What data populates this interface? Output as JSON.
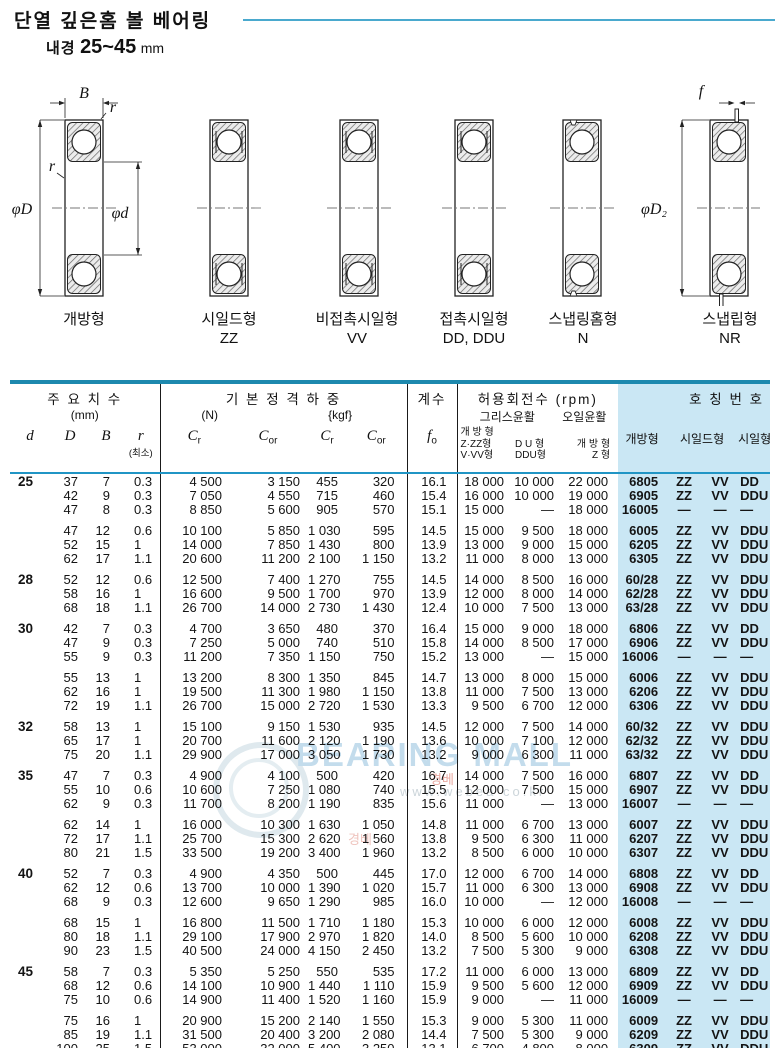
{
  "page": {
    "title": "단열 깊은홈 볼 베어링",
    "subtitle_label": "내경",
    "subtitle_range": "25~45",
    "subtitle_unit": "mm"
  },
  "diagrams": {
    "dim_labels": {
      "B": "B",
      "r": "r",
      "phi_D": "φD",
      "phi_d": "φd",
      "phi_D2": "φD₂",
      "f": "f"
    },
    "types": [
      {
        "name": "개방형",
        "code": ""
      },
      {
        "name": "시일드형",
        "code": "ZZ"
      },
      {
        "name": "비접촉시일형",
        "code": "VV"
      },
      {
        "name": "접촉시일형",
        "code": "DD, DDU"
      },
      {
        "name": "스냅링홈형",
        "code": "N"
      },
      {
        "name": "스냅립형",
        "code": "NR"
      }
    ]
  },
  "watermark": {
    "logo_text": "BEARING MALL",
    "url_text": "www.webea co.kr",
    "red_fragment": "경베"
  },
  "colors": {
    "title_rule": "#4aa9ce",
    "table_border_top": "#1d89ae",
    "table_border_bottom": "#3ab1d8",
    "header_divider": "#2095c5",
    "panel_blue": "#cae7f4"
  },
  "table": {
    "headers": {
      "dims_title": "주 요 치 수",
      "dims_unit": "(mm)",
      "d": "d",
      "D": "D",
      "B": "B",
      "r": "r",
      "r_min": "(최소)",
      "load_title": "기 본 정 격 하 중",
      "load_unit_n": "(N)",
      "load_unit_kgf": "{kgf}",
      "c": "C",
      "c_sub_r": "r",
      "c_sub_or": "or",
      "factor_title": "계수",
      "f0": "f",
      "f0_sub": "o",
      "speed_title": "허용회전수 (rpm)",
      "grease": "그리스윤활",
      "oil": "오일윤활",
      "speed_col1_l1": "개 방 형",
      "speed_col1_l2": "Z·ZZ형",
      "speed_col1_l3": "V·VV형",
      "speed_col2_l1": "D U 형",
      "speed_col2_l2": "DDU형",
      "speed_col3_l1": "개 방 형",
      "speed_col3_l2": "Z 형",
      "number_title": "호 칭 번 호",
      "num_open": "개방형",
      "num_shield": "시일드형",
      "num_seal": "시일형"
    },
    "groups": [
      {
        "d": "25",
        "subgroups": [
          [
            [
              "37",
              "7",
              "0.3",
              "4 500",
              "3 150",
              "455",
              "320",
              "16.1",
              "18 000",
              "10 000",
              "22 000",
              "6805",
              "ZZ",
              "VV",
              "DD"
            ],
            [
              "42",
              "9",
              "0.3",
              "7 050",
              "4 550",
              "715",
              "460",
              "15.4",
              "16 000",
              "10 000",
              "19 000",
              "6905",
              "ZZ",
              "VV",
              "DDU"
            ],
            [
              "47",
              "8",
              "0.3",
              "8 850",
              "5 600",
              "905",
              "570",
              "15.1",
              "15 000",
              "—",
              "18 000",
              "16005",
              "—",
              "—",
              "—"
            ]
          ],
          [
            [
              "47",
              "12",
              "0.6",
              "10 100",
              "5 850",
              "1 030",
              "595",
              "14.5",
              "15 000",
              "9 500",
              "18 000",
              "6005",
              "ZZ",
              "VV",
              "DDU"
            ],
            [
              "52",
              "15",
              "1",
              "14 000",
              "7 850",
              "1 430",
              "800",
              "13.9",
              "13 000",
              "9 000",
              "15 000",
              "6205",
              "ZZ",
              "VV",
              "DDU"
            ],
            [
              "62",
              "17",
              "1.1",
              "20 600",
              "11 200",
              "2 100",
              "1 150",
              "13.2",
              "11 000",
              "8 000",
              "13 000",
              "6305",
              "ZZ",
              "VV",
              "DDU"
            ]
          ]
        ]
      },
      {
        "d": "28",
        "subgroups": [
          [
            [
              "52",
              "12",
              "0.6",
              "12 500",
              "7 400",
              "1 270",
              "755",
              "14.5",
              "14 000",
              "8 500",
              "16 000",
              "60/28",
              "ZZ",
              "VV",
              "DDU"
            ],
            [
              "58",
              "16",
              "1",
              "16 600",
              "9 500",
              "1 700",
              "970",
              "13.9",
              "12 000",
              "8 000",
              "14 000",
              "62/28",
              "ZZ",
              "VV",
              "DDU"
            ],
            [
              "68",
              "18",
              "1.1",
              "26 700",
              "14 000",
              "2 730",
              "1 430",
              "12.4",
              "10 000",
              "7 500",
              "13 000",
              "63/28",
              "ZZ",
              "VV",
              "DDU"
            ]
          ]
        ]
      },
      {
        "d": "30",
        "subgroups": [
          [
            [
              "42",
              "7",
              "0.3",
              "4 700",
              "3 650",
              "480",
              "370",
              "16.4",
              "15 000",
              "9 000",
              "18 000",
              "6806",
              "ZZ",
              "VV",
              "DD"
            ],
            [
              "47",
              "9",
              "0.3",
              "7 250",
              "5 000",
              "740",
              "510",
              "15.8",
              "14 000",
              "8 500",
              "17 000",
              "6906",
              "ZZ",
              "VV",
              "DDU"
            ],
            [
              "55",
              "9",
              "0.3",
              "11 200",
              "7 350",
              "1 150",
              "750",
              "15.2",
              "13 000",
              "—",
              "15 000",
              "16006",
              "—",
              "—",
              "—"
            ]
          ],
          [
            [
              "55",
              "13",
              "1",
              "13 200",
              "8 300",
              "1 350",
              "845",
              "14.7",
              "13 000",
              "8 000",
              "15 000",
              "6006",
              "ZZ",
              "VV",
              "DDU"
            ],
            [
              "62",
              "16",
              "1",
              "19 500",
              "11 300",
              "1 980",
              "1 150",
              "13.8",
              "11 000",
              "7 500",
              "13 000",
              "6206",
              "ZZ",
              "VV",
              "DDU"
            ],
            [
              "72",
              "19",
              "1.1",
              "26 700",
              "15 000",
              "2 720",
              "1 530",
              "13.3",
              "9 500",
              "6 700",
              "12 000",
              "6306",
              "ZZ",
              "VV",
              "DDU"
            ]
          ]
        ]
      },
      {
        "d": "32",
        "subgroups": [
          [
            [
              "58",
              "13",
              "1",
              "15 100",
              "9 150",
              "1 530",
              "935",
              "14.5",
              "12 000",
              "7 500",
              "14 000",
              "60/32",
              "ZZ",
              "VV",
              "DDU"
            ],
            [
              "65",
              "17",
              "1",
              "20 700",
              "11 600",
              "2 120",
              "1 190",
              "13.6",
              "10 000",
              "7 100",
              "12 000",
              "62/32",
              "ZZ",
              "VV",
              "DDU"
            ],
            [
              "75",
              "20",
              "1.1",
              "29 900",
              "17 000",
              "3 050",
              "1 730",
              "13.2",
              "9 000",
              "6 300",
              "11 000",
              "63/32",
              "ZZ",
              "VV",
              "DDU"
            ]
          ]
        ]
      },
      {
        "d": "35",
        "subgroups": [
          [
            [
              "47",
              "7",
              "0.3",
              "4 900",
              "4 100",
              "500",
              "420",
              "16.7",
              "14 000",
              "7 500",
              "16 000",
              "6807",
              "ZZ",
              "VV",
              "DD"
            ],
            [
              "55",
              "10",
              "0.6",
              "10 600",
              "7 250",
              "1 080",
              "740",
              "15.5",
              "12 000",
              "7 500",
              "15 000",
              "6907",
              "ZZ",
              "VV",
              "DDU"
            ],
            [
              "62",
              "9",
              "0.3",
              "11 700",
              "8 200",
              "1 190",
              "835",
              "15.6",
              "11 000",
              "—",
              "13 000",
              "16007",
              "—",
              "—",
              "—"
            ]
          ],
          [
            [
              "62",
              "14",
              "1",
              "16 000",
              "10 300",
              "1 630",
              "1 050",
              "14.8",
              "11 000",
              "6 700",
              "13 000",
              "6007",
              "ZZ",
              "VV",
              "DDU"
            ],
            [
              "72",
              "17",
              "1.1",
              "25 700",
              "15 300",
              "2 620",
              "1 560",
              "13.8",
              "9 500",
              "6 300",
              "11 000",
              "6207",
              "ZZ",
              "VV",
              "DDU"
            ],
            [
              "80",
              "21",
              "1.5",
              "33 500",
              "19 200",
              "3 400",
              "1 960",
              "13.2",
              "8 500",
              "6 000",
              "10 000",
              "6307",
              "ZZ",
              "VV",
              "DDU"
            ]
          ]
        ]
      },
      {
        "d": "40",
        "subgroups": [
          [
            [
              "52",
              "7",
              "0.3",
              "4 900",
              "4 350",
              "500",
              "445",
              "17.0",
              "12 000",
              "6 700",
              "14 000",
              "6808",
              "ZZ",
              "VV",
              "DD"
            ],
            [
              "62",
              "12",
              "0.6",
              "13 700",
              "10 000",
              "1 390",
              "1 020",
              "15.7",
              "11 000",
              "6 300",
              "13 000",
              "6908",
              "ZZ",
              "VV",
              "DDU"
            ],
            [
              "68",
              "9",
              "0.3",
              "12 600",
              "9 650",
              "1 290",
              "985",
              "16.0",
              "10 000",
              "—",
              "12 000",
              "16008",
              "—",
              "—",
              "—"
            ]
          ],
          [
            [
              "68",
              "15",
              "1",
              "16 800",
              "11 500",
              "1 710",
              "1 180",
              "15.3",
              "10 000",
              "6 000",
              "12 000",
              "6008",
              "ZZ",
              "VV",
              "DDU"
            ],
            [
              "80",
              "18",
              "1.1",
              "29 100",
              "17 900",
              "2 970",
              "1 820",
              "14.0",
              "8 500",
              "5 600",
              "10 000",
              "6208",
              "ZZ",
              "VV",
              "DDU"
            ],
            [
              "90",
              "23",
              "1.5",
              "40 500",
              "24 000",
              "4 150",
              "2 450",
              "13.2",
              "7 500",
              "5 300",
              "9 000",
              "6308",
              "ZZ",
              "VV",
              "DDU"
            ]
          ]
        ]
      },
      {
        "d": "45",
        "subgroups": [
          [
            [
              "58",
              "7",
              "0.3",
              "5 350",
              "5 250",
              "550",
              "535",
              "17.2",
              "11 000",
              "6 000",
              "13 000",
              "6809",
              "ZZ",
              "VV",
              "DD"
            ],
            [
              "68",
              "12",
              "0.6",
              "14 100",
              "10 900",
              "1 440",
              "1 110",
              "15.9",
              "9 500",
              "5 600",
              "12 000",
              "6909",
              "ZZ",
              "VV",
              "DDU"
            ],
            [
              "75",
              "10",
              "0.6",
              "14 900",
              "11 400",
              "1 520",
              "1 160",
              "15.9",
              "9 000",
              "—",
              "11 000",
              "16009",
              "—",
              "—",
              "—"
            ]
          ],
          [
            [
              "75",
              "16",
              "1",
              "20 900",
              "15 200",
              "2 140",
              "1 550",
              "15.3",
              "9 000",
              "5 300",
              "11 000",
              "6009",
              "ZZ",
              "VV",
              "DDU"
            ],
            [
              "85",
              "19",
              "1.1",
              "31 500",
              "20 400",
              "3 200",
              "2 080",
              "14.4",
              "7 500",
              "5 300",
              "9 000",
              "6209",
              "ZZ",
              "VV",
              "DDU"
            ],
            [
              "100",
              "25",
              "1.5",
              "53 000",
              "32 000",
              "5 400",
              "3 250",
              "13.1",
              "6 700",
              "4 800",
              "8 000",
              "6309",
              "ZZ",
              "VV",
              "DDU"
            ]
          ]
        ]
      }
    ]
  }
}
